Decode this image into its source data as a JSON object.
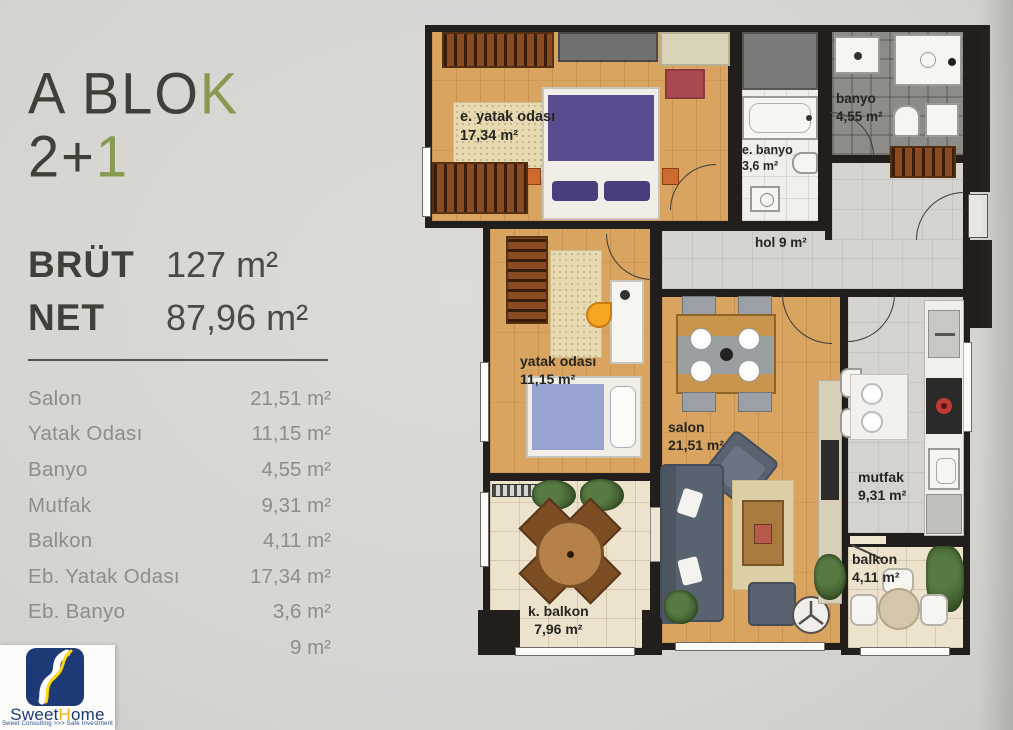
{
  "colors": {
    "page_bg": "#d8d7d4",
    "title_dark": "#3d4138",
    "accent_olive": "#879a50",
    "list_text": "#8e8d8b",
    "wall_black": "#211e1b",
    "floor_wood": "#d9a360",
    "floor_tile_beige": "#ede3cd",
    "floor_bath_gray": "#8e8c89",
    "floor_hall_gray": "#d4d3d0",
    "bed_purple": "#5b4b8f",
    "single_bed_blue": "#99a3d2",
    "sofa_gray": "#59636f",
    "ottoman_red": "#a84a50",
    "logo_blue": "#1d3a77",
    "logo_yellow": "#ffd60a"
  },
  "panel": {
    "title": {
      "dark": "A BLO",
      "green": "K"
    },
    "subtitle": {
      "dark": "2+",
      "green": "1"
    },
    "brut": {
      "label": "BRÜT",
      "value": "127 m²"
    },
    "net": {
      "label": "NET",
      "value": "87,96 m²"
    },
    "rooms": [
      {
        "label": "Salon",
        "value": "21,51 m²"
      },
      {
        "label": "Yatak Odası",
        "value": "11,15 m²"
      },
      {
        "label": "Banyo",
        "value": "4,55 m²"
      },
      {
        "label": "Mutfak",
        "value": "9,31 m²"
      },
      {
        "label": "Balkon",
        "value": "4,11 m²"
      },
      {
        "label": "Eb. Yatak Odası",
        "value": "17,34 m²"
      },
      {
        "label": "Eb. Banyo",
        "value": "3,6 m²"
      },
      {
        "label": "",
        "value": "9 m²"
      }
    ]
  },
  "logo": {
    "brand_part1": "Sweet",
    "brand_accent": "H",
    "brand_part2": "ome",
    "tagline": "Sweet Consulting >>> Safe Investment"
  },
  "plan": {
    "rooms": {
      "master_bedroom": {
        "name": "e. yatak odası",
        "area": "17,34 m²"
      },
      "ensuite_bath": {
        "name": "e. banyo",
        "area": "3,6 m²"
      },
      "bathroom": {
        "name": "banyo",
        "area": "4,55 m²"
      },
      "hall": {
        "name": "hol",
        "area": "9 m²"
      },
      "bedroom": {
        "name": "yatak odası",
        "area": "11,15 m²"
      },
      "living_room": {
        "name": "salon",
        "area": "21,51 m²"
      },
      "kitchen": {
        "name": "mutfak",
        "area": "9,31 m²"
      },
      "closed_balcony": {
        "name": "k. balkon",
        "area": "7,96 m²"
      },
      "balcony": {
        "name": "balkon",
        "area": "4,11 m²"
      }
    }
  }
}
